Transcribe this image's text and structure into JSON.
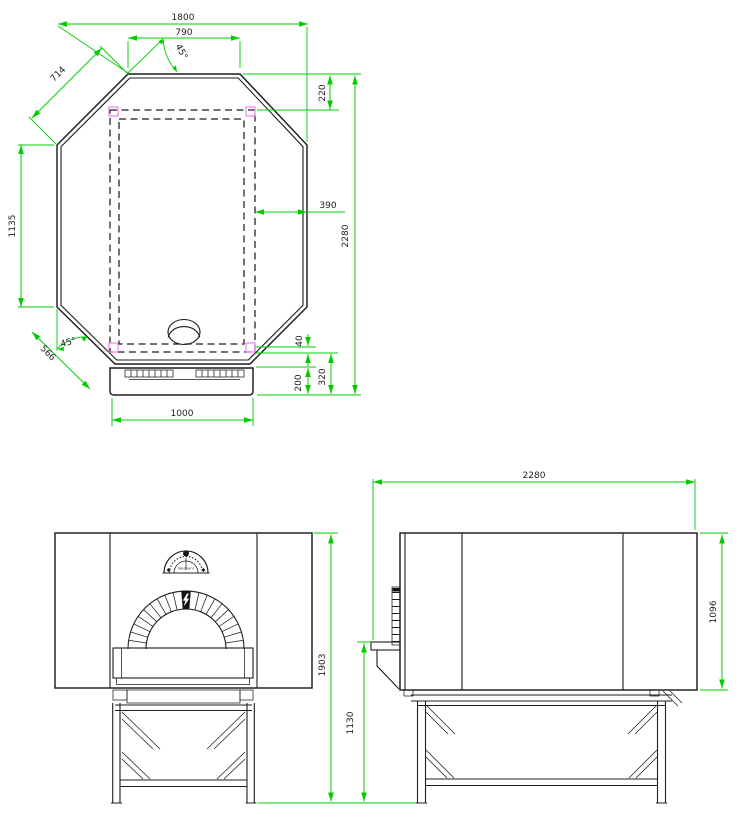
{
  "colors": {
    "line": "#1d1d1d",
    "dimension": "#00cc00",
    "anchor_highlight": "#f274f2",
    "background": "#ffffff"
  },
  "views": {
    "top": {
      "dims": {
        "overall_width": "1800",
        "front_edge": "790",
        "front_corner_angle": "45°",
        "front_chamfer": "714",
        "side_length": "1135",
        "overall_depth": "2280",
        "wall_offset": "390",
        "rear_corner_angle": "45°",
        "rear_chamfer": "566",
        "vent_gap": "40",
        "landing_overall": "320",
        "landing_depth": "200",
        "landing_width": "1000"
      }
    },
    "front": {
      "gauge_brand": "Valoriani",
      "dims": {
        "total_height": "1903",
        "stand_height": "1130"
      }
    },
    "side": {
      "dims": {
        "overall_length": "2280",
        "body_height": "1096"
      }
    }
  }
}
